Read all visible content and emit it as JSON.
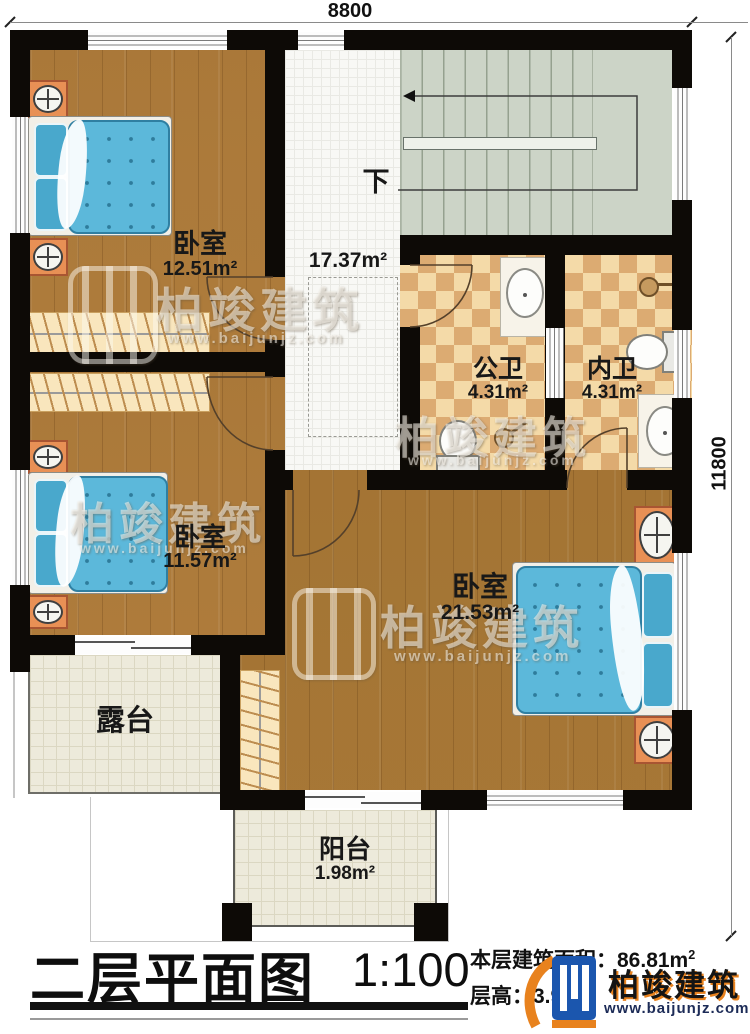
{
  "dims": {
    "width_label": "8800",
    "height_label": "11800"
  },
  "rooms": {
    "bedroom_top_left": {
      "name": "卧室",
      "area": "12.51m²"
    },
    "bedroom_bottom_left": {
      "name": "卧室",
      "area": "11.57m²"
    },
    "bedroom_master": {
      "name": "卧室",
      "area": "21.53m²"
    },
    "hallway": {
      "area": "17.37m²",
      "stair_direction": "下"
    },
    "bath_public": {
      "name": "公卫",
      "area": "4.31m²"
    },
    "bath_private": {
      "name": "内卫",
      "area": "4.31m²"
    },
    "terrace": {
      "name": "露台"
    },
    "balcony": {
      "name": "阳台",
      "area": "1.98m²"
    }
  },
  "footer": {
    "title": "二层平面图",
    "scale": "1:100",
    "floor_area_label": "本层建筑面积：",
    "floor_area_value": "86.81m",
    "floor_area_sup": "2",
    "floor_height_label": "层高：",
    "floor_height_value": "3.90m"
  },
  "brand": {
    "name": "柏竣建筑",
    "website": "www.baijunjz.com"
  },
  "watermark": {
    "name": "柏竣建筑",
    "website": "www.baijunjz.com"
  },
  "colors": {
    "wall": "#0d0a06",
    "wood_floor": "#b17f3e",
    "bath_tile_light": "#f4daa8",
    "bath_tile_dark": "#dcab72",
    "stair": "#ccd4c7",
    "bed": "#5cb8da",
    "nightstand": "#e89055",
    "brand_blue": "#1b56ae",
    "brand_orange": "#e8821e"
  }
}
